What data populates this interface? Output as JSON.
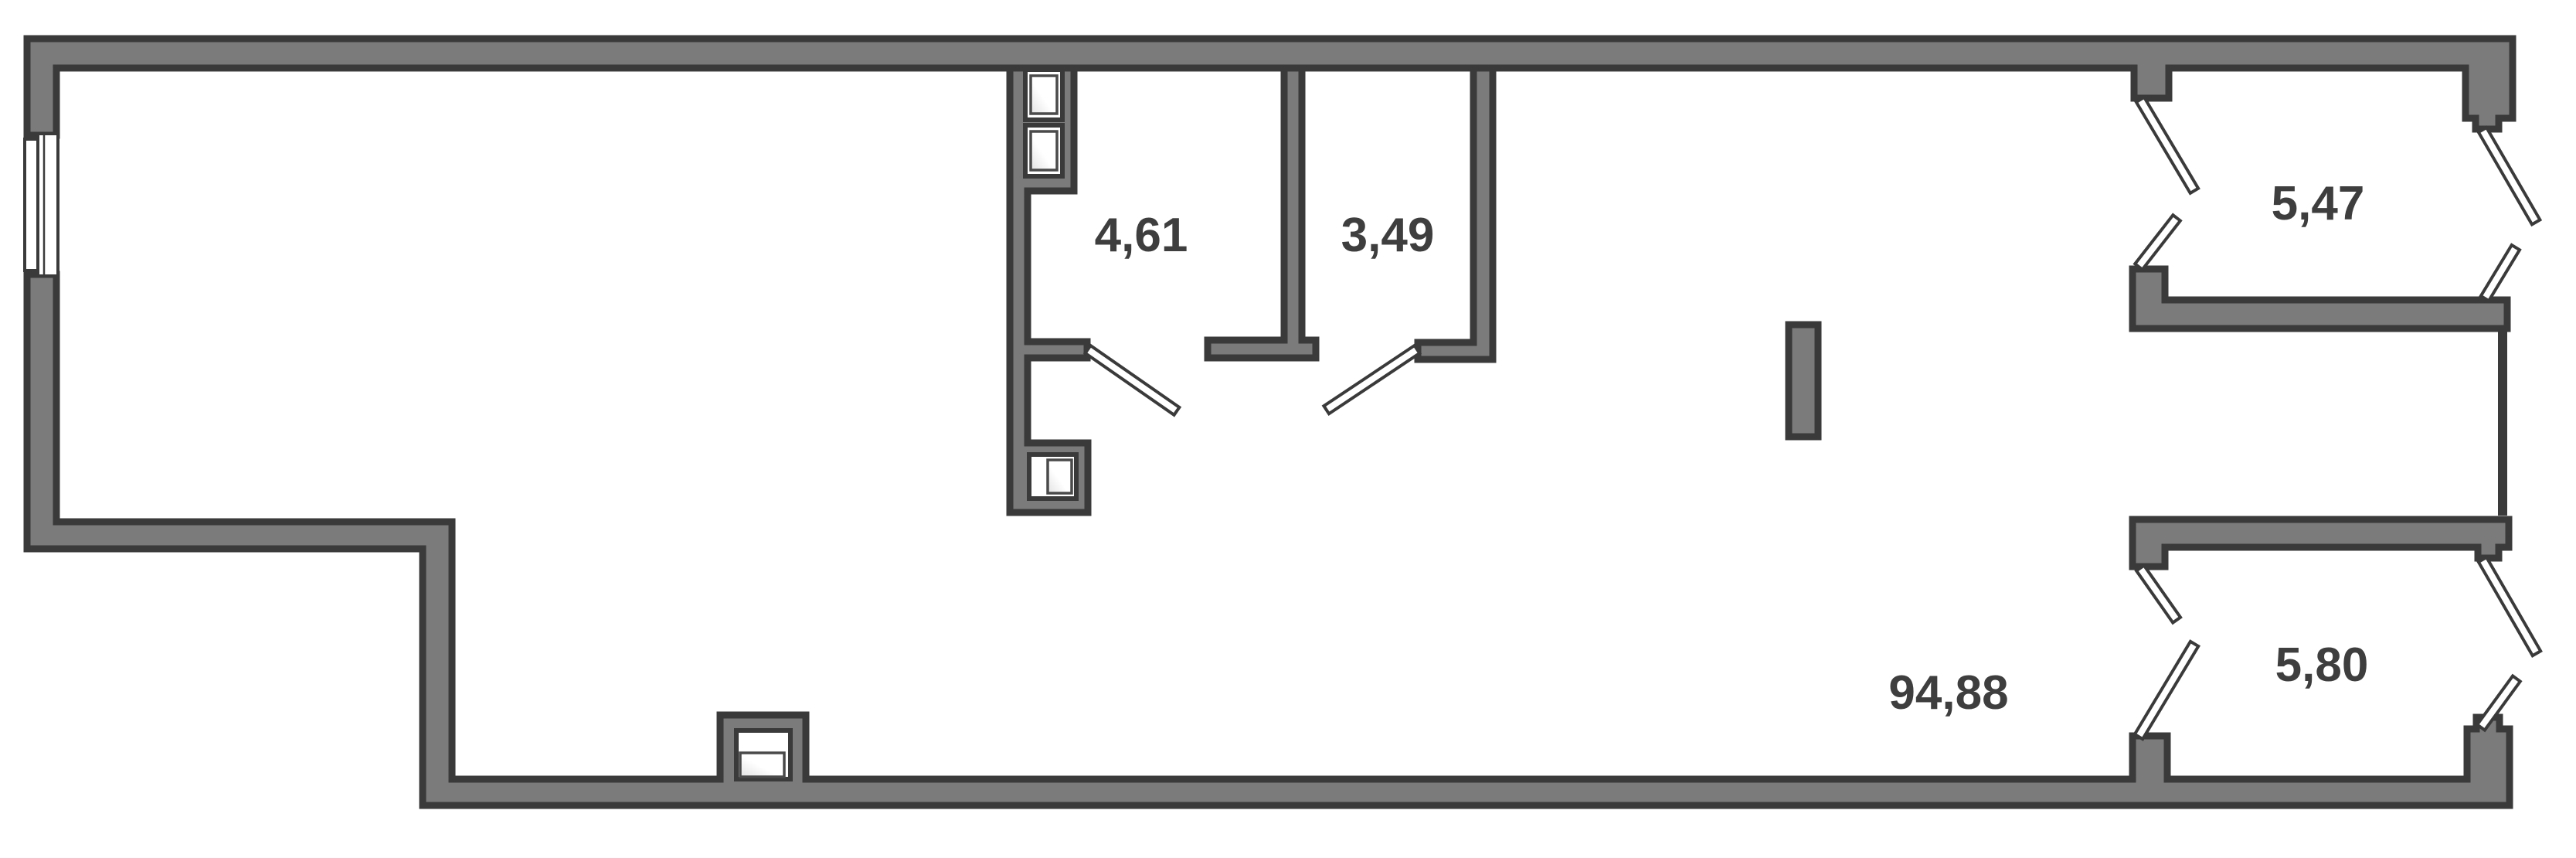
{
  "plan": {
    "type": "floor-plan",
    "units": "m2",
    "background_color": "#FFFFFF",
    "wall_fill_color": "#7B7B7B",
    "wall_outline_color": "#3A3A3A",
    "label_color": "#3E3E3E",
    "door_leaf_color": "#FFFFFF"
  },
  "rooms": [
    {
      "id": "room-1",
      "label": "4,61"
    },
    {
      "id": "room-2",
      "label": "3,49"
    },
    {
      "id": "room-3",
      "label": "5,47"
    },
    {
      "id": "room-4",
      "label": "94,88"
    },
    {
      "id": "room-5",
      "label": "5,80"
    }
  ]
}
